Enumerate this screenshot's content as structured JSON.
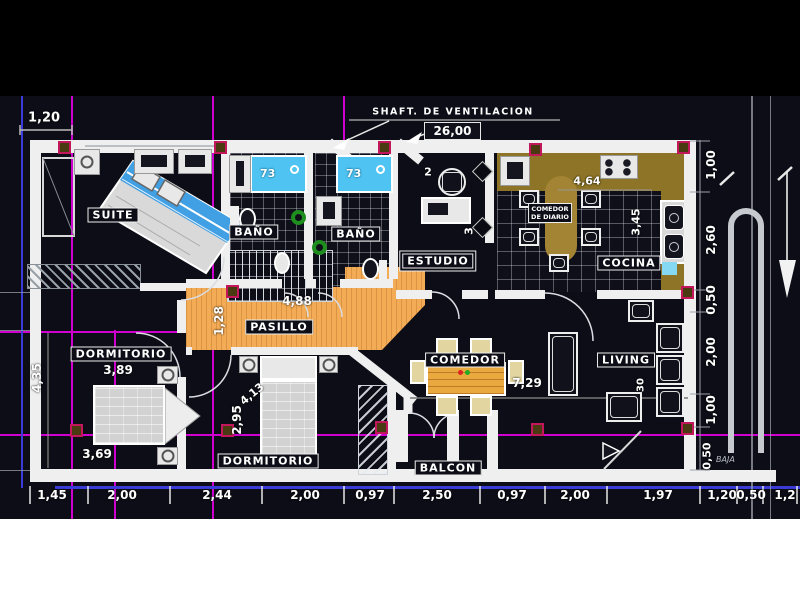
{
  "colors": {
    "canvas_bg": "#0d0d17",
    "top_band_bg": "#000000",
    "bottom_band_bg": "#ffffff",
    "wall": "#efefef",
    "pasillo_floor": "#f3ab55",
    "kitchen_counter": "#8d7426",
    "bathtub_blue": "#4fc4f2",
    "bed_blanket_blue": "#419fe3",
    "construction_magenta": "#cf00cf",
    "construction_blue": "#3b3bd8",
    "column_border": "#c2185b",
    "column_fill": "#4a3a12",
    "drain_green": "#1e8f1e",
    "table_wood": "#e9a93f"
  },
  "annotations": {
    "scale_note": "1,20",
    "shaft_label": "SHAFT. DE VENTILACION",
    "shaft_dim": "26,00",
    "stair_note": "BAJA",
    "stair_dim": "0,50"
  },
  "rooms": {
    "suite": "SUITE",
    "bano1": "BAÑO",
    "bano2": "BAÑO",
    "estudio": "ESTUDIO",
    "cocina": "COCINA",
    "comedor_diario_line1": "COMEDOR",
    "comedor_diario_line2": "DE DIARIO",
    "pasillo": "PASILLO",
    "dormitorio1": "DORMITORIO",
    "dormitorio2": "DORMITORIO",
    "comedor": "COMEDOR",
    "living": "LIVING",
    "balcon": "BALCON"
  },
  "dimensions": {
    "bottom_chain": [
      "1,45",
      "2,00",
      "2,44",
      "2,00",
      "0,97",
      "2,50",
      "0,97",
      "2,00",
      "1,97",
      "1,20",
      "0,50",
      "1,2"
    ],
    "right_chain": [
      "1,00",
      "2,60",
      "0,50",
      "2,00",
      "1,00"
    ],
    "left_height": "4,35",
    "tub1": "73",
    "tub2": "73",
    "pasillo_length": "4,88",
    "pasillo_width": "1,28",
    "dorm1_width_upper": "3,89",
    "dorm1_width_lower": "3,69",
    "dorm2_height": "2,95",
    "dorm2_bed_diag": "4,13",
    "comedor_length": "7,29",
    "cocina_width": "4,64",
    "cocina_depth": "3,45",
    "estudio_w": "2",
    "estudio_h": "3",
    "living_h": "30"
  }
}
